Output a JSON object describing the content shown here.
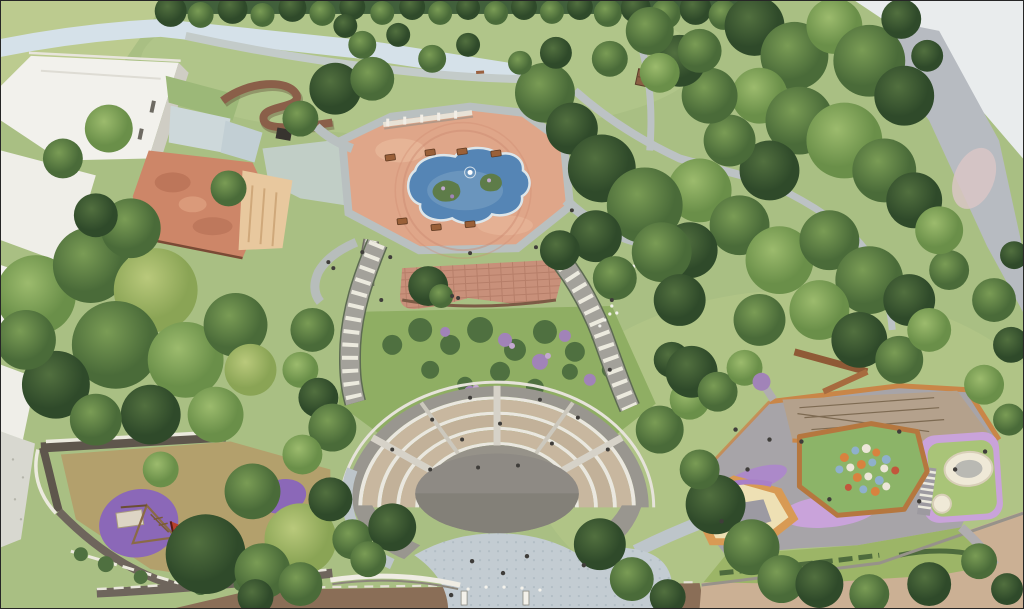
{
  "scene": {
    "description": "Aerial 3D architectural rendering (physical-model style) of a terraced public park",
    "view": "bird's-eye oblique",
    "features": [
      "white residential buildings",
      "terracotta-roof heritage building",
      "elevated timber switchback walkway",
      "ornamental pond with planted islands and fountain",
      "picnic plaza with pergola and tables",
      "brick overlook terrace",
      "flower garden slope",
      "twin cascading garden staircases",
      "semicircular terraced amphitheater with stage",
      "cobblestone forecourt plaza",
      "toddler playground with purple safety surfacing",
      "adventure playground with ball mound, sand pits and rope course",
      "perimeter roads and woodland canopy"
    ]
  },
  "palette": {
    "lawn": "#a9bf83",
    "lawn_light": "#bccb8f",
    "garden_green": "#8fae63",
    "road_pale": "#d5e1e9",
    "corner_pale": "#e9eced",
    "road_gray": "#b7bbc1",
    "road_brown": "#8a6e57",
    "road_tan": "#cbb094",
    "building_white": "#f2f1ec",
    "building_shade": "#cfcdc4",
    "roof_terracotta": "#cd8668",
    "roof_peach": "#e8c89e",
    "walkway_brown": "#8a5f49",
    "plaza_salmon": "#dfa689",
    "pond_blue": "#5585b5",
    "path_gray": "#b9c0c0",
    "cobble_gray": "#c3ccd2",
    "terrace_brick": "#c8907a",
    "seating_tan": "#c8b79f",
    "seating_tan2": "#c2b199",
    "ring_gray": "#99968f",
    "step_white": "#eae7df",
    "stage_gray": "#8e8a84",
    "playground_olive": "#b3a06c",
    "playground_purple": "#8b68b8",
    "playground_gray": "#a7a4a8",
    "playground_lavender": "#c9a3da",
    "sand_cream": "#eee0b4",
    "sandpit_gray": "#9c9aa2",
    "border_orange": "#c98648",
    "mound_green": "#8cb468",
    "ball_orange": "#d8823f",
    "ball_blue": "#8fb0cc",
    "ball_white": "#ece6d8",
    "ball_red": "#c2563c",
    "people": "#3f3d3a",
    "tree_dark_hi": "#52703f",
    "tree_dark_lo": "#2f4a2a",
    "tree_mid_hi": "#7a9c55",
    "tree_mid_lo": "#4a6b39",
    "tree_light_hi": "#9cbb6d",
    "tree_light_lo": "#6a8f49",
    "tree_yellow_hi": "#b9c97b",
    "tree_yellow_lo": "#8aa455"
  }
}
